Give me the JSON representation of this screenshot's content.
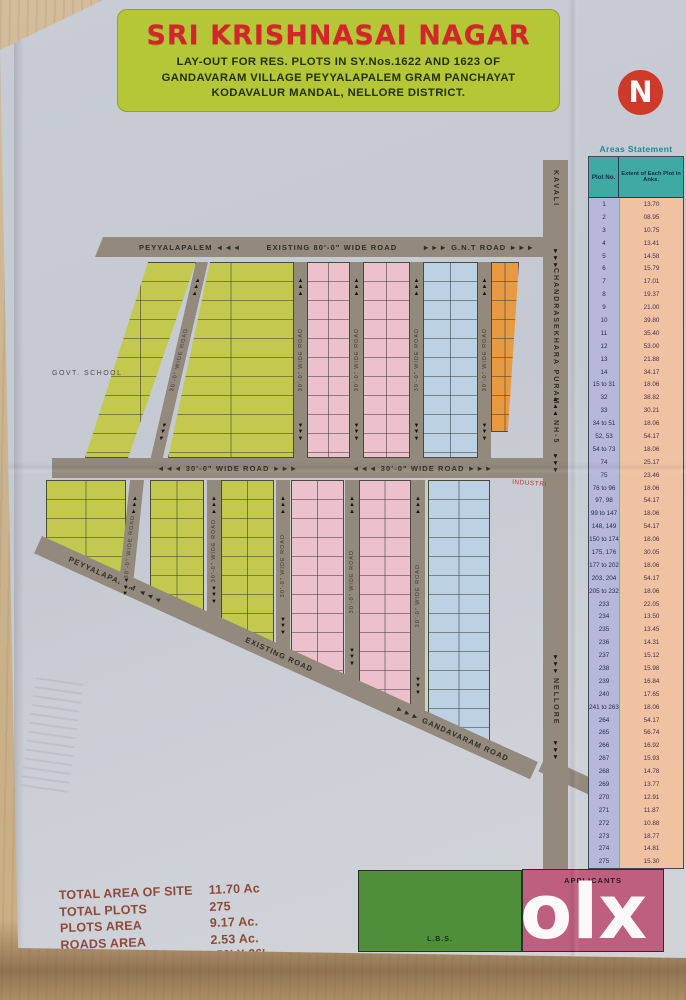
{
  "banner": {
    "title": "SRI KRISHNASAI NAGAR",
    "line1": "LAY-OUT FOR RES. PLOTS IN SY.Nos.1622 AND 1623 OF",
    "line2": "GANDAVARAM VILLAGE PEYYALAPALEM GRAM PANCHAYAT",
    "line3": "KODAVALUR MANDAL, NELLORE DISTRICT."
  },
  "compass": {
    "letter": "N"
  },
  "map": {
    "roads": {
      "top_left": "PEYYALAPALEM ◄◄◄",
      "top_mid": "EXISTING 80'-0\" WIDE ROAD",
      "top_right": "►►►  G.N.T ROAD  ►►►",
      "middle": "◄◄◄  30'-0\" WIDE ROAD  ►►►",
      "internal": "30'-0\" WIDE ROAD",
      "right_top": "KAVALI",
      "right_mid": "CHANDRASEKHARA PURAM",
      "right_nh": "NH-5",
      "right_bottom": "NELLORE",
      "diag_left": "PEYYALAPALEM ◄◄◄",
      "diag_mid": "EXISTING ROAD",
      "diag_right": "►►►  GANDAVARAM ROAD",
      "up_arrows": "▲▲▲",
      "down_arrows": "▼▼▼"
    },
    "landmarks": {
      "school": "GOVT. SCHOOL",
      "industrial": "INDUSTRI"
    },
    "legend_blocks": {
      "lbs": "L.B.S.",
      "applicants": "APPLICANTS"
    }
  },
  "areas_statement": {
    "title": "Areas Statement",
    "col1": "Plot No.",
    "col2": "Extent of Each Plot in Anks.",
    "rows": [
      [
        "1",
        "13.70"
      ],
      [
        "2",
        "08.95"
      ],
      [
        "3",
        "10.75"
      ],
      [
        "4",
        "13.41"
      ],
      [
        "5",
        "14.58"
      ],
      [
        "6",
        "15.79"
      ],
      [
        "7",
        "17.01"
      ],
      [
        "8",
        "19.37"
      ],
      [
        "9",
        "21.00"
      ],
      [
        "10",
        "39.80"
      ],
      [
        "11",
        "35.40"
      ],
      [
        "12",
        "53.00"
      ],
      [
        "13",
        "21.88"
      ],
      [
        "14",
        "34.17"
      ],
      [
        "15 to 31",
        "18.06"
      ],
      [
        "32",
        "38.82"
      ],
      [
        "33",
        "30.21"
      ],
      [
        "34 to 51",
        "18.06"
      ],
      [
        "52, 53",
        "54.17"
      ],
      [
        "54 to 73",
        "18.06"
      ],
      [
        "74",
        "25.17"
      ],
      [
        "75",
        "23.46"
      ],
      [
        "76 to 96",
        "18.06"
      ],
      [
        "97, 98",
        "54.17"
      ],
      [
        "99 to 147",
        "18.06"
      ],
      [
        "148, 149",
        "54.17"
      ],
      [
        "150 to 174",
        "18.06"
      ],
      [
        "175, 176",
        "30.05"
      ],
      [
        "177 to 202",
        "18.06"
      ],
      [
        "203, 204",
        "54.17"
      ],
      [
        "205 to 232",
        "18.06"
      ],
      [
        "233",
        "22.05"
      ],
      [
        "234",
        "13.50"
      ],
      [
        "235",
        "13.45"
      ],
      [
        "236",
        "14.31"
      ],
      [
        "237",
        "15.12"
      ],
      [
        "238",
        "15.98"
      ],
      [
        "239",
        "16.84"
      ],
      [
        "240",
        "17.65"
      ],
      [
        "241 to 263",
        "18.06"
      ],
      [
        "264",
        "54.17"
      ],
      [
        "265",
        "56.74"
      ],
      [
        "266",
        "16.92"
      ],
      [
        "267",
        "15.93"
      ],
      [
        "268",
        "14.78"
      ],
      [
        "269",
        "13.77"
      ],
      [
        "270",
        "12.91"
      ],
      [
        "271",
        "11.87"
      ],
      [
        "272",
        "10.88"
      ],
      [
        "273",
        "18.77"
      ],
      [
        "274",
        "14.81"
      ],
      [
        "275",
        "15.30"
      ]
    ]
  },
  "stats": {
    "rows": [
      [
        "TOTAL AREA OF SITE",
        "11.70 Ac"
      ],
      [
        "TOTAL PLOTS",
        "275"
      ],
      [
        "PLOTS AREA",
        "9.17 Ac."
      ],
      [
        "ROADS AREA",
        "2.53 Ac."
      ]
    ],
    "each_plot": "EACH PLOT 50' x 78' AND 50' X 26'"
  },
  "watermark": "olx",
  "colors": {
    "banner_green": "#b5c636",
    "title_red": "#d3262a",
    "compass_red": "#cf3a28",
    "road_gray": "#93897d",
    "plot_yellow": "#c2c94e",
    "plot_pink": "#edc0ce",
    "plot_blue": "#bcd2e4",
    "plot_orange": "#e89a40",
    "lbs_green": "#4f8f3b",
    "applicants_rose": "#bf5f7f",
    "table_teal": "#3fa9a4",
    "table_lavender": "#b6b7d9",
    "table_peach": "#f0c2a2",
    "stats_maroon": "#8f4a38"
  }
}
